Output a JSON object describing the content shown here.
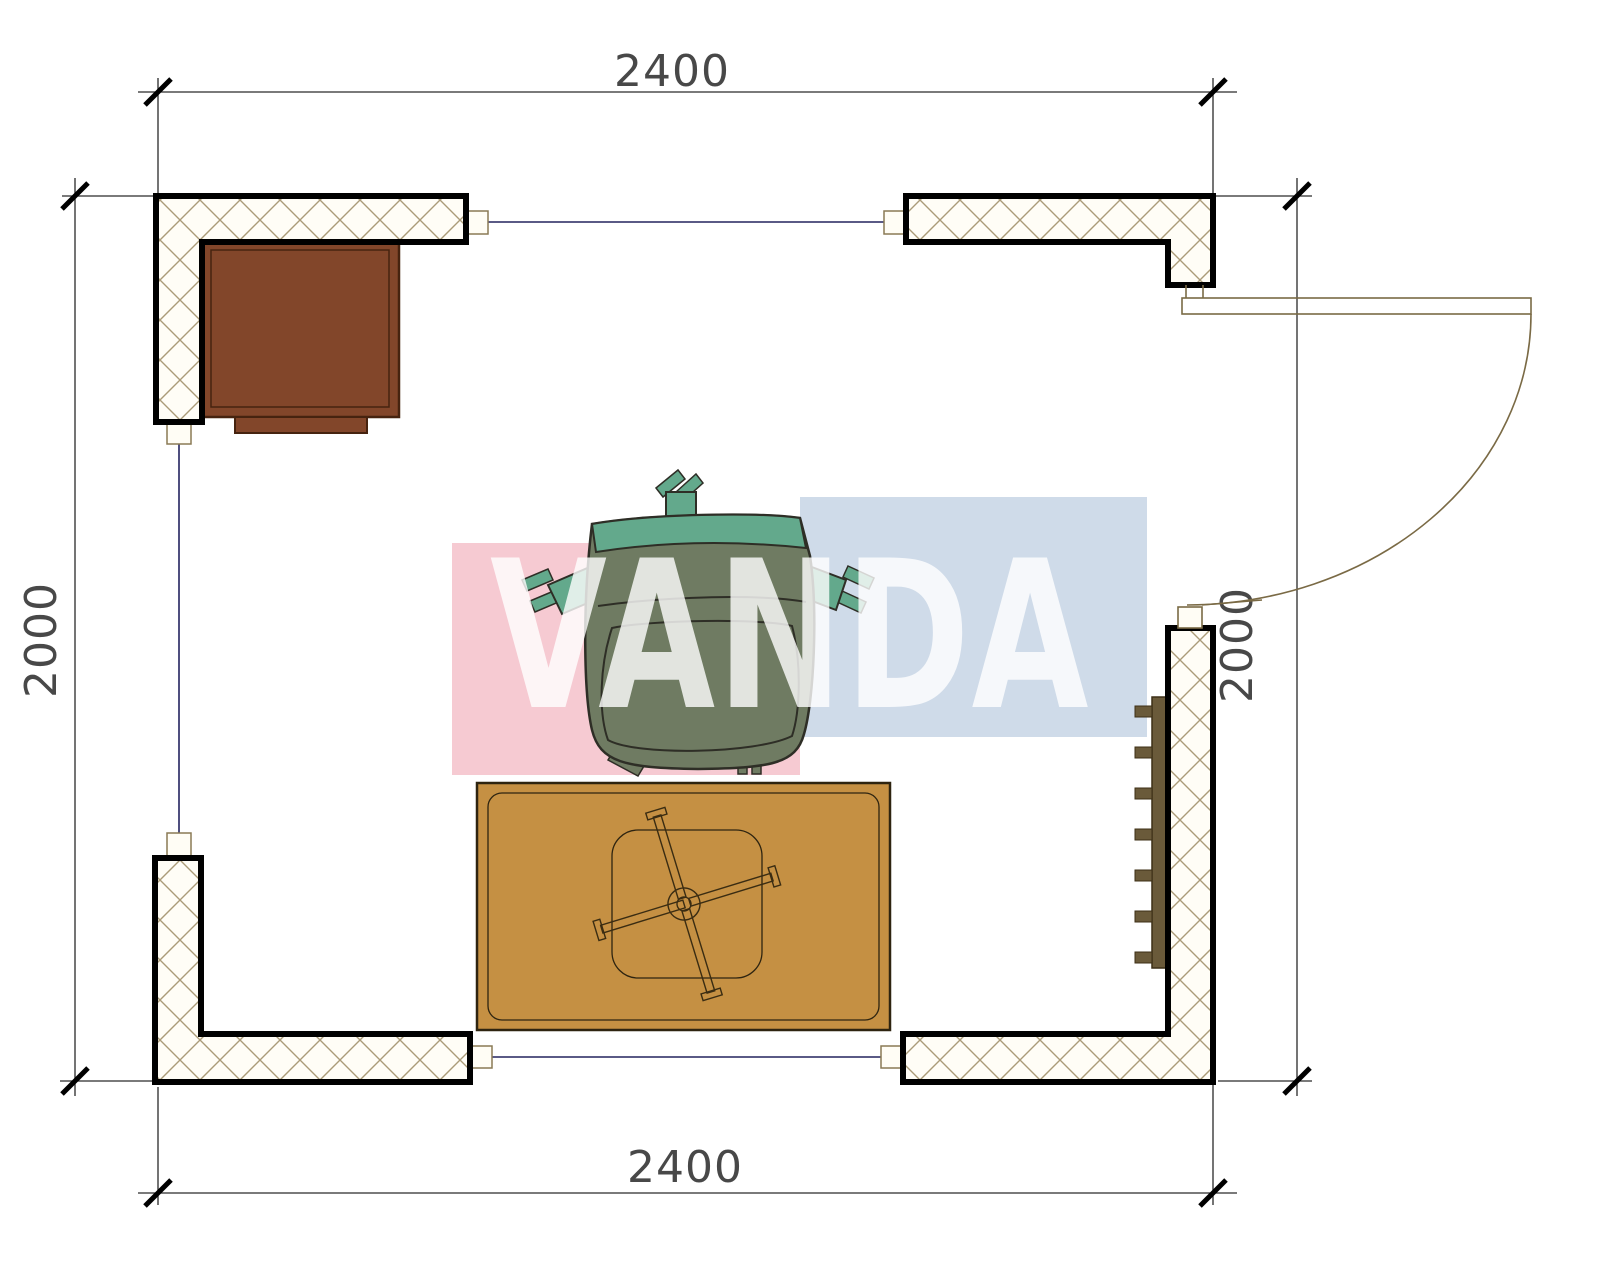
{
  "dimensions": {
    "top": "2400",
    "bottom": "2400",
    "left": "2000",
    "right": "2000"
  },
  "watermark": {
    "text": "VANDA",
    "pink_color": "#f6cad2",
    "blue_color": "#cfdbe9",
    "text_color": "rgba(255,255,255,0.8)"
  },
  "colors": {
    "wall_outline": "#000000",
    "hatch": "#ab9b78",
    "wall_fill": "#fffdf6",
    "connector_fill": "#fffdf5",
    "connector_outline": "#8a7a55",
    "cabinet": "#82462a",
    "cabinet_outline": "#46230f",
    "table": "#c59043",
    "table_outline": "#2e2410",
    "chair_body": "#6f7b62",
    "chair_accent": "#63a98c",
    "chair_outline": "#2e2e26",
    "radiator": "#6a5a3a",
    "radiator_outline": "#3c2f16",
    "door": "#7a6a45",
    "opening_line": "#23235f",
    "dimension_line": "#2a2a2a"
  }
}
